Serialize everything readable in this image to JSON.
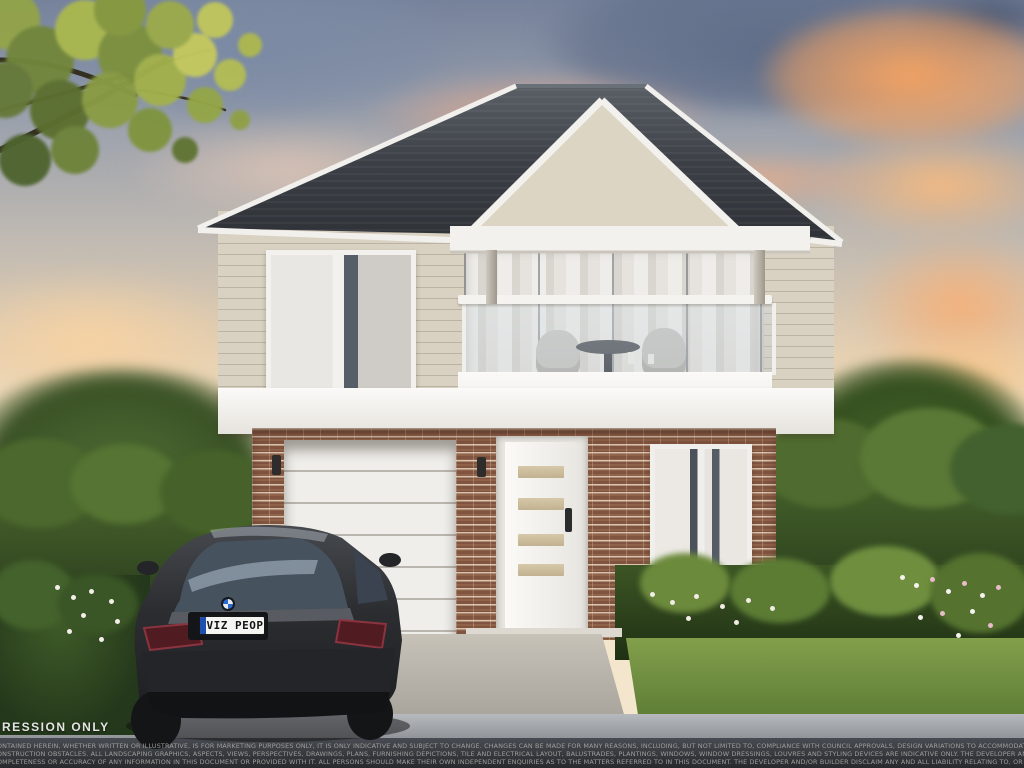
{
  "scene": {
    "type": "artist-impression-architectural-render",
    "subject": "Two-storey house with covered balcony, weatherboard upper level, brick ground floor with garage and white front door, dark SUV parked on the driveway under a sunset sky"
  },
  "watermark": {
    "text": "RESSION ONLY"
  },
  "car": {
    "license_plate": "VIZ PEOP",
    "badge": "bmw-roundel"
  },
  "disclaimer": {
    "lines": [
      "ONTAINED HEREIN, WHETHER WRITTEN OR ILLUSTRATIVE, IS FOR MARKETING PURPOSES ONLY, IT IS ONLY INDICATIVE AND SUBJECT TO CHANGE. CHANGES CAN BE MADE FOR MANY REASONS, INCLUDING, BUT NOT LIMITED TO, COMPLIANCE WITH COUNCIL APPROVALS, DESIGN VARIATIONS TO ACCOMMODATE SITE REQUIREMENTS, COMPLIANCE WITH BASIX REGULATIONS, AVAILABILITY OF MATERIAL",
      "ONSTRUCTION OBSTACLES. ALL LANDSCAPING GRAPHICS, ASPECTS, VIEWS, PERSPECTIVES, DRAWINGS, PLANS, FURNISHING DEPICTIONS, TILE AND ELECTRICAL LAYOUT, BALUSTRADES, PLANTINGS, WINDOWS, WINDOW DRESSINGS, LOUVRES AND STYLING DEVICES ARE INDICATIVE ONLY. THE DEVELOPER AND/OR BUILDER DO NOT GIVE ANY WARRANTY OR MAKE ANY REPRESENTATIONS, WHETHER",
      "OMPLETENESS OR ACCURACY OF ANY INFORMATION IN THIS DOCUMENT OR PROVIDED WITH IT. ALL PERSONS SHOULD MAKE THEIR OWN INDEPENDENT ENQUIRIES AS TO THE MATTERS REFERRED TO IN THIS DOCUMENT. THE DEVELOPER AND/OR BUILDER DISCLAIM ANY AND ALL LIABILITY RELATING TO, OR RESULTING FROM, THE USE OF, OR THE RELIANCE ON, ANY INFORMATION IN THIS DOCUMEN"
    ]
  },
  "colors": {
    "sky_top": "#76829b",
    "sunset_orange": "#f2a263",
    "horizon_cream": "#f7ead0",
    "roof": "#3c4046",
    "cladding": "#d9d2c2",
    "brick": "#91624a",
    "trim_white": "#f3f1ed",
    "lawn": "#6f8f3f",
    "driveway": "#b8b3aa",
    "road": "#33363b",
    "car_body": "#2b2d30",
    "plate_blue": "#1e4fae"
  }
}
